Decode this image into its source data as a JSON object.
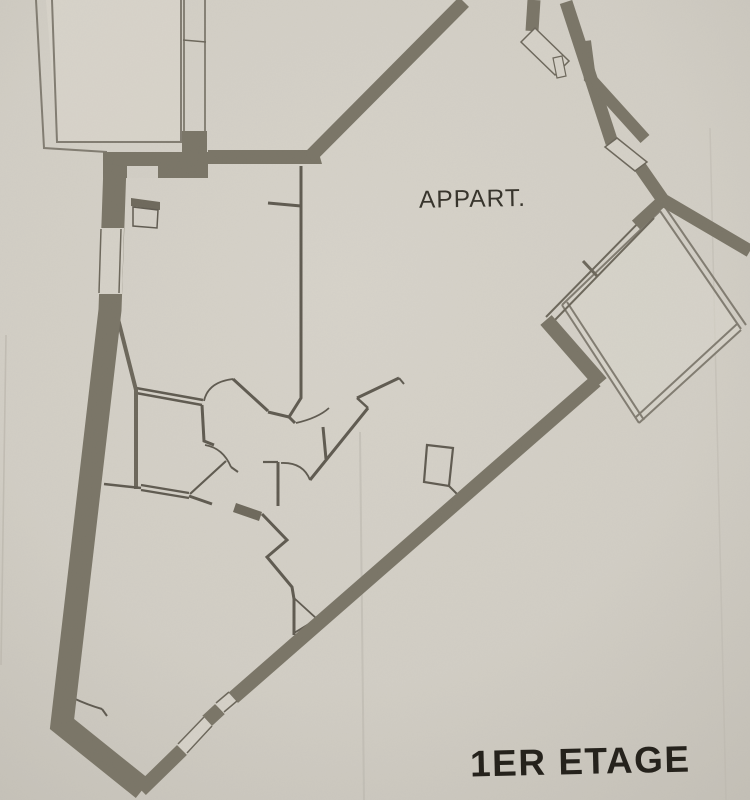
{
  "document": {
    "type": "architectural-floor-plan",
    "labels": {
      "apartment": "APPART.",
      "floor": "1ER ETAGE"
    },
    "colors": {
      "paper_center": "#d6d2c9",
      "paper_mid": "#d0ccc3",
      "paper_edge": "#c2beb5",
      "wall_thick": "#7a7567",
      "wall_dark": "#6e695c",
      "thin_line": "#5f5a50",
      "balcony_line": "#817c71",
      "balcony_fill": "#dad6cd",
      "window_white": "#d8d4cb",
      "text_apartment": "#35322a",
      "text_floor": "#221f19",
      "crease": "#c3bfb6"
    }
  }
}
